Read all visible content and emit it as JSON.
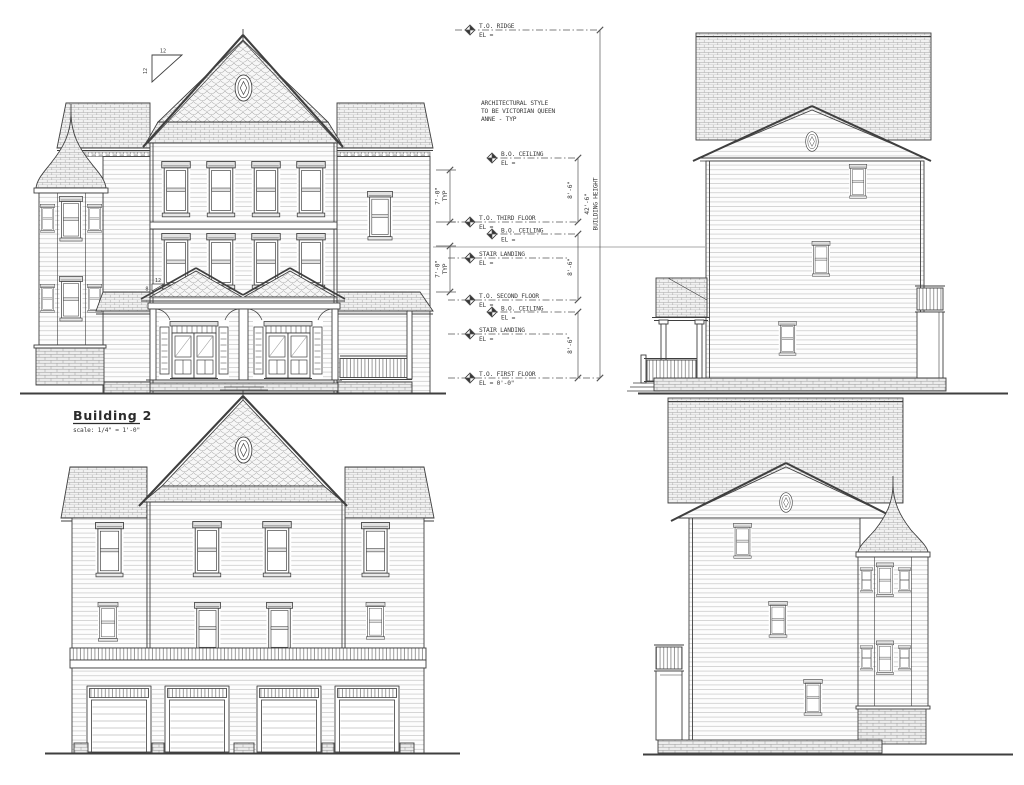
{
  "drawing": {
    "building_label": "Building 2",
    "scale_label": "scale:  1/4\" = 1'-0\"",
    "style_note_line1": "ARCHITECTURAL STYLE",
    "style_note_line2": "TO BE VICTORIAN QUEEN",
    "style_note_line3": "ANNE - TYP",
    "levels": [
      {
        "name": "T.O. RIDGE",
        "el": "EL ="
      },
      {
        "name": "B.O. CEILING",
        "el": "EL ="
      },
      {
        "name": "T.O. THIRD FLOOR",
        "el": "EL ="
      },
      {
        "name": "B.O. CEILING",
        "el": "EL ="
      },
      {
        "name": "STAIR LANDING",
        "el": "EL ="
      },
      {
        "name": "T.O. SECOND FLOOR",
        "el": "EL ="
      },
      {
        "name": "B.O. CEILING",
        "el": "EL ="
      },
      {
        "name": "STAIR LANDING",
        "el": "EL ="
      },
      {
        "name": "T.O. FIRST FLOOR",
        "el": "EL = 0'-0\""
      }
    ],
    "dimensions": {
      "story_height": "8'-6\"",
      "ceiling_typ": "7'-0\"",
      "typ": "TYP",
      "building_height_value": "42'-6\"",
      "building_height_label": "BUILDING HEIGHT"
    },
    "pitch": {
      "main_rise": "12",
      "main_run": "12",
      "porch_rise": "8",
      "porch_run": "12"
    },
    "colors": {
      "line": "#3f3f3f",
      "pattern": "#a6a6a6",
      "paper": "#ffffff"
    }
  }
}
